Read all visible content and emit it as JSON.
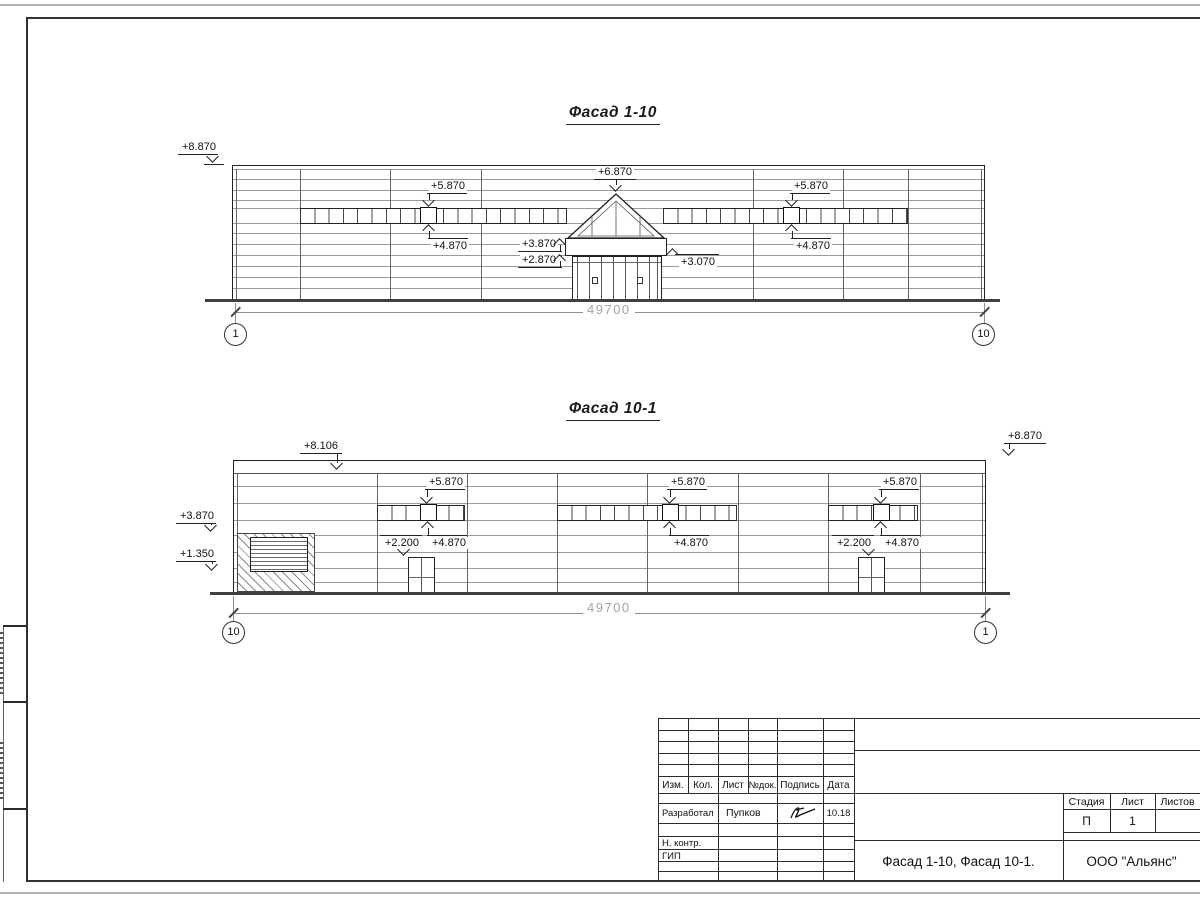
{
  "facade1": {
    "title": "Фасад 1-10",
    "dimension": "49700",
    "axis_left": "1",
    "axis_right": "10",
    "marks": [
      {
        "label": "+8.870",
        "lx": 180,
        "ly": 141,
        "sx": 178,
        "sy": 154,
        "sw": 40,
        "tx": 213,
        "ty": 163,
        "dir": "down",
        "stem": false,
        "bx": 204,
        "by": 164,
        "bw": 20
      },
      {
        "label": "+5.870",
        "lx": 429,
        "ly": 180,
        "sx": 427,
        "sy": 193,
        "sw": 40,
        "tx": 429,
        "ty": 207,
        "dir": "down",
        "stem": true
      },
      {
        "label": "+4.870",
        "lx": 431,
        "ly": 240,
        "sx": 428,
        "sy": 238,
        "sw": 40,
        "tx": 429,
        "ty": 224,
        "dir": "up",
        "stem": true
      },
      {
        "label": "+6.870",
        "lx": 596,
        "ly": 166,
        "sx": 594,
        "sy": 179,
        "sw": 42,
        "tx": 616,
        "ty": 192,
        "dir": "down",
        "stem": true
      },
      {
        "label": "+3.870",
        "lx": 520,
        "ly": 238,
        "sx": 518,
        "sy": 251,
        "sw": 44,
        "tx": 560,
        "ty": 238,
        "dir": "up",
        "stem": true
      },
      {
        "label": "+2.870",
        "lx": 520,
        "ly": 254,
        "sx": 518,
        "sy": 267,
        "sw": 44,
        "tx": 560,
        "ty": 254,
        "dir": "up",
        "stem": true
      },
      {
        "label": "+3.070",
        "lx": 679,
        "ly": 256,
        "sx": 675,
        "sy": 254,
        "sw": 44,
        "tx": 673,
        "ty": 248,
        "dir": "up",
        "stem": false
      },
      {
        "label": "+5.870",
        "lx": 792,
        "ly": 180,
        "sx": 790,
        "sy": 193,
        "sw": 40,
        "tx": 792,
        "ty": 207,
        "dir": "down",
        "stem": true
      },
      {
        "label": "+4.870",
        "lx": 794,
        "ly": 240,
        "sx": 791,
        "sy": 238,
        "sw": 40,
        "tx": 792,
        "ty": 224,
        "dir": "up",
        "stem": true
      }
    ]
  },
  "facade2": {
    "title": "Фасад 10-1",
    "dimension": "49700",
    "axis_left": "10",
    "axis_right": "1",
    "marks": [
      {
        "label": "+8.106",
        "lx": 302,
        "ly": 440,
        "sx": 300,
        "sy": 453,
        "sw": 42,
        "tx": 337,
        "ty": 470,
        "dir": "down",
        "stem": true
      },
      {
        "label": "+8.870",
        "lx": 1006,
        "ly": 430,
        "sx": 1004,
        "sy": 443,
        "sw": 42,
        "tx": 1009,
        "ty": 456,
        "dir": "down",
        "stem": true
      },
      {
        "label": "+3.870",
        "lx": 178,
        "ly": 510,
        "sx": 176,
        "sy": 523,
        "sw": 40,
        "tx": 211,
        "ty": 532,
        "dir": "down",
        "stem": true
      },
      {
        "label": "+1.350",
        "lx": 178,
        "ly": 548,
        "sx": 176,
        "sy": 561,
        "sw": 40,
        "tx": 212,
        "ty": 571,
        "dir": "down",
        "stem": true
      },
      {
        "label": "+5.870",
        "lx": 427,
        "ly": 476,
        "sx": 425,
        "sy": 489,
        "sw": 40,
        "tx": 427,
        "ty": 504,
        "dir": "down",
        "stem": true
      },
      {
        "label": "+4.870",
        "lx": 430,
        "ly": 537,
        "sx": 427,
        "sy": 535,
        "sw": 40,
        "tx": 428,
        "ty": 521,
        "dir": "up",
        "stem": true
      },
      {
        "label": "+2.200",
        "lx": 383,
        "ly": 537,
        "sx": 380,
        "sy": 535,
        "sw": 42,
        "tx": 404,
        "ty": 556,
        "dir": "down",
        "stem": false
      },
      {
        "label": "+5.870",
        "lx": 669,
        "ly": 476,
        "sx": 667,
        "sy": 489,
        "sw": 40,
        "tx": 670,
        "ty": 504,
        "dir": "down",
        "stem": true
      },
      {
        "label": "+4.870",
        "lx": 672,
        "ly": 537,
        "sx": 669,
        "sy": 535,
        "sw": 40,
        "tx": 670,
        "ty": 521,
        "dir": "up",
        "stem": true
      },
      {
        "label": "+5.870",
        "lx": 881,
        "ly": 476,
        "sx": 879,
        "sy": 489,
        "sw": 40,
        "tx": 881,
        "ty": 504,
        "dir": "down",
        "stem": true
      },
      {
        "label": "+4.870",
        "lx": 883,
        "ly": 537,
        "sx": 880,
        "sy": 535,
        "sw": 40,
        "tx": 881,
        "ty": 521,
        "dir": "up",
        "stem": true
      },
      {
        "label": "+2.200",
        "lx": 835,
        "ly": 537,
        "sx": 832,
        "sy": 535,
        "sw": 42,
        "tx": 869,
        "ty": 556,
        "dir": "down",
        "stem": false
      }
    ]
  },
  "titleblock": {
    "header_cols": [
      "Изм.",
      "Кол.",
      "Лист",
      "№док.",
      "Подпись",
      "Дата"
    ],
    "developed_label": "Разработал",
    "developed_name": "Пупков",
    "developed_date": "10.18",
    "ncontr_label": "Н. контр.",
    "gip_label": "ГИП",
    "stage_label": "Стадия",
    "sheet_label": "Лист",
    "sheets_label": "Листов",
    "stage_value": "П",
    "sheet_value": "1",
    "doc_title": "Фасад 1-10, Фасад 10-1.",
    "organization": "ООО \"Альянс\""
  }
}
